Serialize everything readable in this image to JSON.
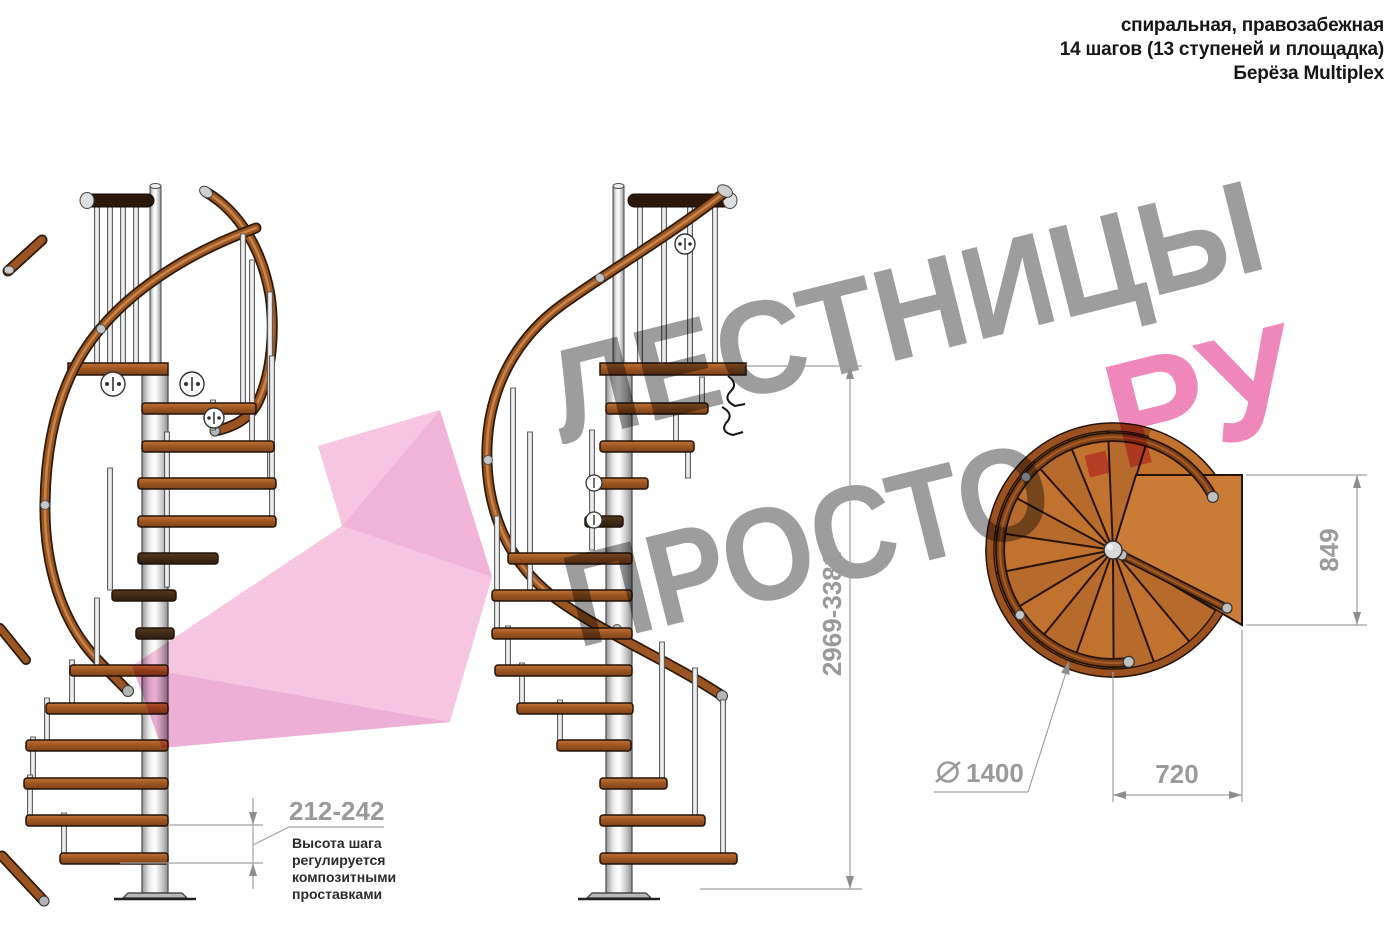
{
  "header": {
    "line1": "спиральная, правозабежная",
    "line2": "14 шагов (13 ступеней и площадка)",
    "line3": "Берёза Multiplex"
  },
  "watermark": {
    "word1": "ЛЕСТНИЦЫ",
    "word2": "ПРОСТО",
    "word3": ".РУ",
    "text_gray": "#9d9d9d",
    "pink": "#ef87ba",
    "arrow_pink": "#f09cce"
  },
  "views": {
    "side_view_count": 2,
    "top_view": "план (вид сверху)",
    "steps_total": 14,
    "treads": 13,
    "has_landing": true
  },
  "dimensions": {
    "step_height": "212-242",
    "note_line1": "Высота шага",
    "note_line2": "регулируется",
    "note_line3": "композитными",
    "note_line4": "проставками",
    "total_height": "2969-3381",
    "landing_depth": "849",
    "tread_width": "720",
    "diameter_value": "1400",
    "diameter_symbol": "∅"
  },
  "colors": {
    "wood_light": "#aa6128",
    "wood_dark": "#3f2a16",
    "handrail": "#9b5523",
    "pole_gray": "#d8d8d8",
    "dim_gray": "#9f9f9f",
    "text_dark": "#161616"
  }
}
